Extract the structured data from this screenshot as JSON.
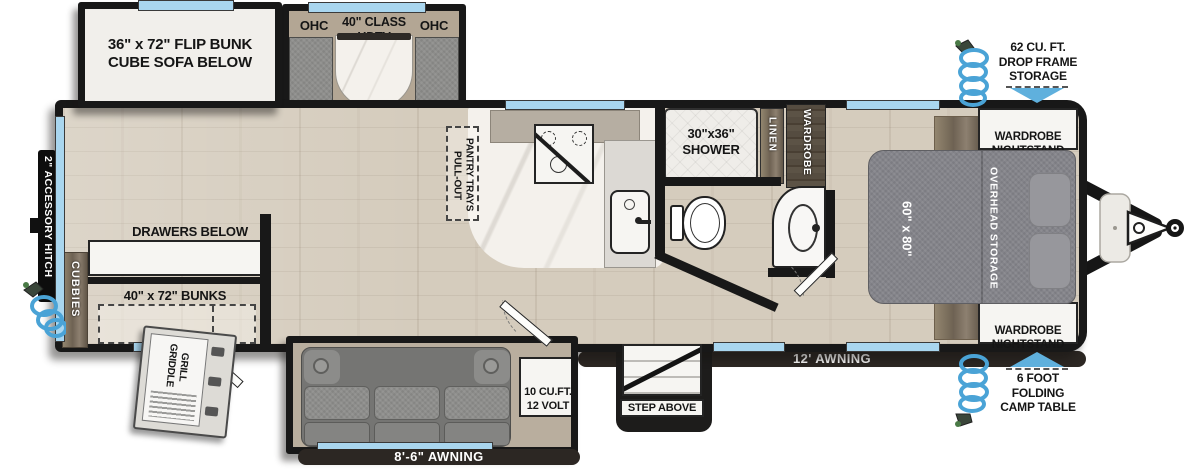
{
  "colors": {
    "wall": "#181818",
    "window_blue": "#a9d6ef",
    "accent_blue": "#5fb0dd",
    "awning_bar": "#2c2723",
    "floor_wood": "#d5ccbd",
    "label_text": "#151515"
  },
  "slides": {
    "flip_bunk": {
      "label": "36\" x 72\" FLIP BUNK\nCUBE SOFA BELOW"
    },
    "media": {
      "ohc_left": "OHC",
      "tv": "40\" CLASS\nHDTV",
      "ohc_right": "OHC"
    },
    "sofa": {
      "fridge": "10 CU.FT.\n12 VOLT"
    }
  },
  "bunk_room": {
    "drawers": "DRAWERS BELOW",
    "bunks_size": "40\" x 72\" BUNKS",
    "cubbies": "CUBBIES"
  },
  "kitchen": {
    "pantry": "PULL-OUT\nPANTRY TRAYS"
  },
  "bathroom": {
    "shower": "30\"x36\"\nSHOWER",
    "linen": "LINEN",
    "wardrobe": "WARDROBE"
  },
  "bedroom": {
    "bed_size": "60\" x 80\"",
    "overhead_storage": "OVERHEAD STORAGE",
    "nightstand_top": "WARDROBE\nNIGHTSTAND",
    "nightstand_bottom": "WARDROBE\nNIGHTSTAND"
  },
  "exterior": {
    "accessory_hitch": "2\" ACCESSORY HITCH",
    "griddle": "GRIDDLE\nGRILL",
    "step": "STEP ABOVE",
    "awning_main": "12' AWNING",
    "awning_rear": "8'-6\" AWNING",
    "drop_frame_storage": "62 CU. FT.\nDROP FRAME\nSTORAGE",
    "camp_table": "6 FOOT\nFOLDING\nCAMP TABLE"
  },
  "icons": {
    "spray_port": "coiled-hose-sprayer",
    "storage_arrow": "▼",
    "camp_table_arrow": "▲"
  }
}
